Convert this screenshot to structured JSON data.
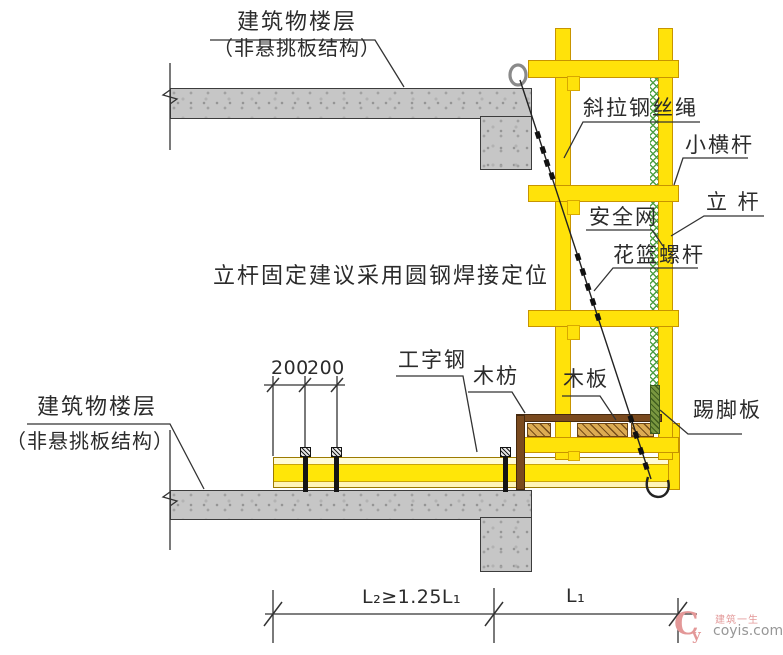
{
  "labels": {
    "floor_top": {
      "line1": "建筑物楼层",
      "line2": "（非悬挑板结构）"
    },
    "floor_bottom": {
      "line1": "建筑物楼层",
      "line2": "（非悬挑板结构）"
    },
    "wire_rope": "斜拉钢丝绳",
    "small_cross_bar": "小横杆",
    "pole": "立 杆",
    "safety_net": "安全网",
    "turnbuckle": "花篮螺杆",
    "note": "立杆固定建议采用圆钢焊接定位",
    "i_beam": "工字钢",
    "wood_batten": "木枋",
    "wood_plank": "木板",
    "toe_board": "踢脚板"
  },
  "dimensions": {
    "offset_left": "200",
    "offset_right": "200",
    "span_anchor": "L₂≥1.25L₁",
    "span_cantilever": "L₁"
  },
  "watermark": {
    "logo_c": "C",
    "logo_y": "y",
    "brand": "建筑一生",
    "site": "coyis.com"
  },
  "colors": {
    "scaffold_yellow": "#ffe20a",
    "safety_net_green": "#4fa045",
    "toe_board_green": "#79973f",
    "wood_brown": "#7a4a1e",
    "plank_tan": "#dcab52",
    "concrete_gray": "#c6c6c6",
    "line_dark": "#2b2b2b",
    "watermark_pink": "#e39898"
  }
}
